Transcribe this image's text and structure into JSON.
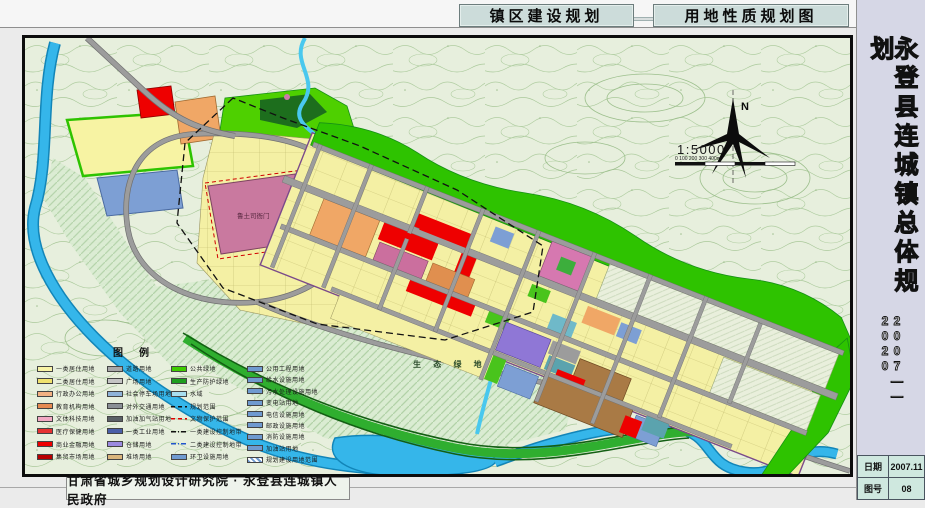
{
  "header": {
    "left_title": "镇区建设规划",
    "right_title": "用地性质规划图"
  },
  "sidebar": {
    "title": "永登县连城镇总体规划",
    "years": "2007——2020",
    "info": {
      "date_label": "日期",
      "date_value": "2007.11",
      "sheet_label": "图号",
      "sheet_value": "08"
    }
  },
  "footer": {
    "credit": "甘肃省城乡规划设计研究院 · 永登县连城镇人民政府"
  },
  "map": {
    "labels": {
      "north": "N",
      "scale_ratio": "1:5000",
      "scale_ticks": "0     100    200    300    400m",
      "eco_green": "生 态 绿 地",
      "heritage_site": "鲁土司衙门"
    },
    "colors": {
      "residential_yellow": "#f4f0a4",
      "commercial_red": "#ee0000",
      "admin_orange": "#f0a766",
      "heritage_mauve": "#c9799f",
      "industry_purple": "#8f77d6",
      "warehouse_brown": "#a97a45",
      "utility_blue": "#7d9fd4",
      "public_green": "#2ec300",
      "protection_dark_green": "#1d6e1d",
      "water_blue": "#35b6ea",
      "road_grey": "#9c9c9c",
      "topo_background": "#e7efdd"
    }
  },
  "legend": {
    "title": "图例",
    "columns": [
      {
        "items": [
          {
            "label": "一类居住用地",
            "color": "#f8f3a6"
          },
          {
            "label": "二类居住用地",
            "color": "#f0e26e"
          },
          {
            "label": "行政办公用地",
            "color": "#f3b183"
          },
          {
            "label": "教育机构用地",
            "color": "#e68a52"
          },
          {
            "label": "文体科技用地",
            "color": "#f2a9c4"
          },
          {
            "label": "医疗保健用地",
            "color": "#e63232"
          },
          {
            "label": "商业金融用地",
            "color": "#ee0000"
          },
          {
            "label": "集贸市场用地",
            "color": "#b80000"
          }
        ]
      },
      {
        "items": [
          {
            "label": "道路用地",
            "color": "#a8a8a8"
          },
          {
            "label": "广场用地",
            "color": "#c4c4c4"
          },
          {
            "label": "社会停车场用地",
            "color": "#8fb3d9"
          },
          {
            "label": "对外交通用地",
            "color": "#8a8f96"
          },
          {
            "label": "加油加气站用地",
            "color": "#5a5f66"
          },
          {
            "label": "一类工业用地",
            "color": "#4a5fa8"
          },
          {
            "label": "仓储用地",
            "color": "#9b8ae0"
          },
          {
            "label": "堆场用地",
            "color": "#d9b57c"
          }
        ]
      },
      {
        "items": [
          {
            "label": "公共绿地",
            "color": "#3ecc00"
          },
          {
            "label": "生产防护绿地",
            "color": "#1e9e1e"
          },
          {
            "label": "水域",
            "color": "#a8dff0"
          },
          {
            "label": "规划范围",
            "style": "dash-black"
          },
          {
            "label": "文物保护范围",
            "style": "dash-red"
          },
          {
            "label": "一类建设控制地带",
            "style": "dashdot-black"
          },
          {
            "label": "二类建设控制地带",
            "style": "dashdot-blue"
          },
          {
            "label": "环卫设施用地",
            "color": "#6f9ad0"
          }
        ]
      },
      {
        "items": [
          {
            "label": "公用工程用地",
            "color": "#6f9ad0"
          },
          {
            "label": "给水设施用地",
            "color": "#6f9ad0"
          },
          {
            "label": "污水处理设施用地",
            "color": "#6f9ad0"
          },
          {
            "label": "变电站用地",
            "color": "#6f9ad0"
          },
          {
            "label": "电信设施用地",
            "color": "#6f9ad0"
          },
          {
            "label": "邮政设施用地",
            "color": "#6f9ad0"
          },
          {
            "label": "消防设施用地",
            "color": "#6f9ad0"
          },
          {
            "label": "加油站用地",
            "color": "#6f9ad0"
          },
          {
            "label": "规划建设用地范围",
            "style": "hatch-blue"
          }
        ]
      }
    ]
  }
}
